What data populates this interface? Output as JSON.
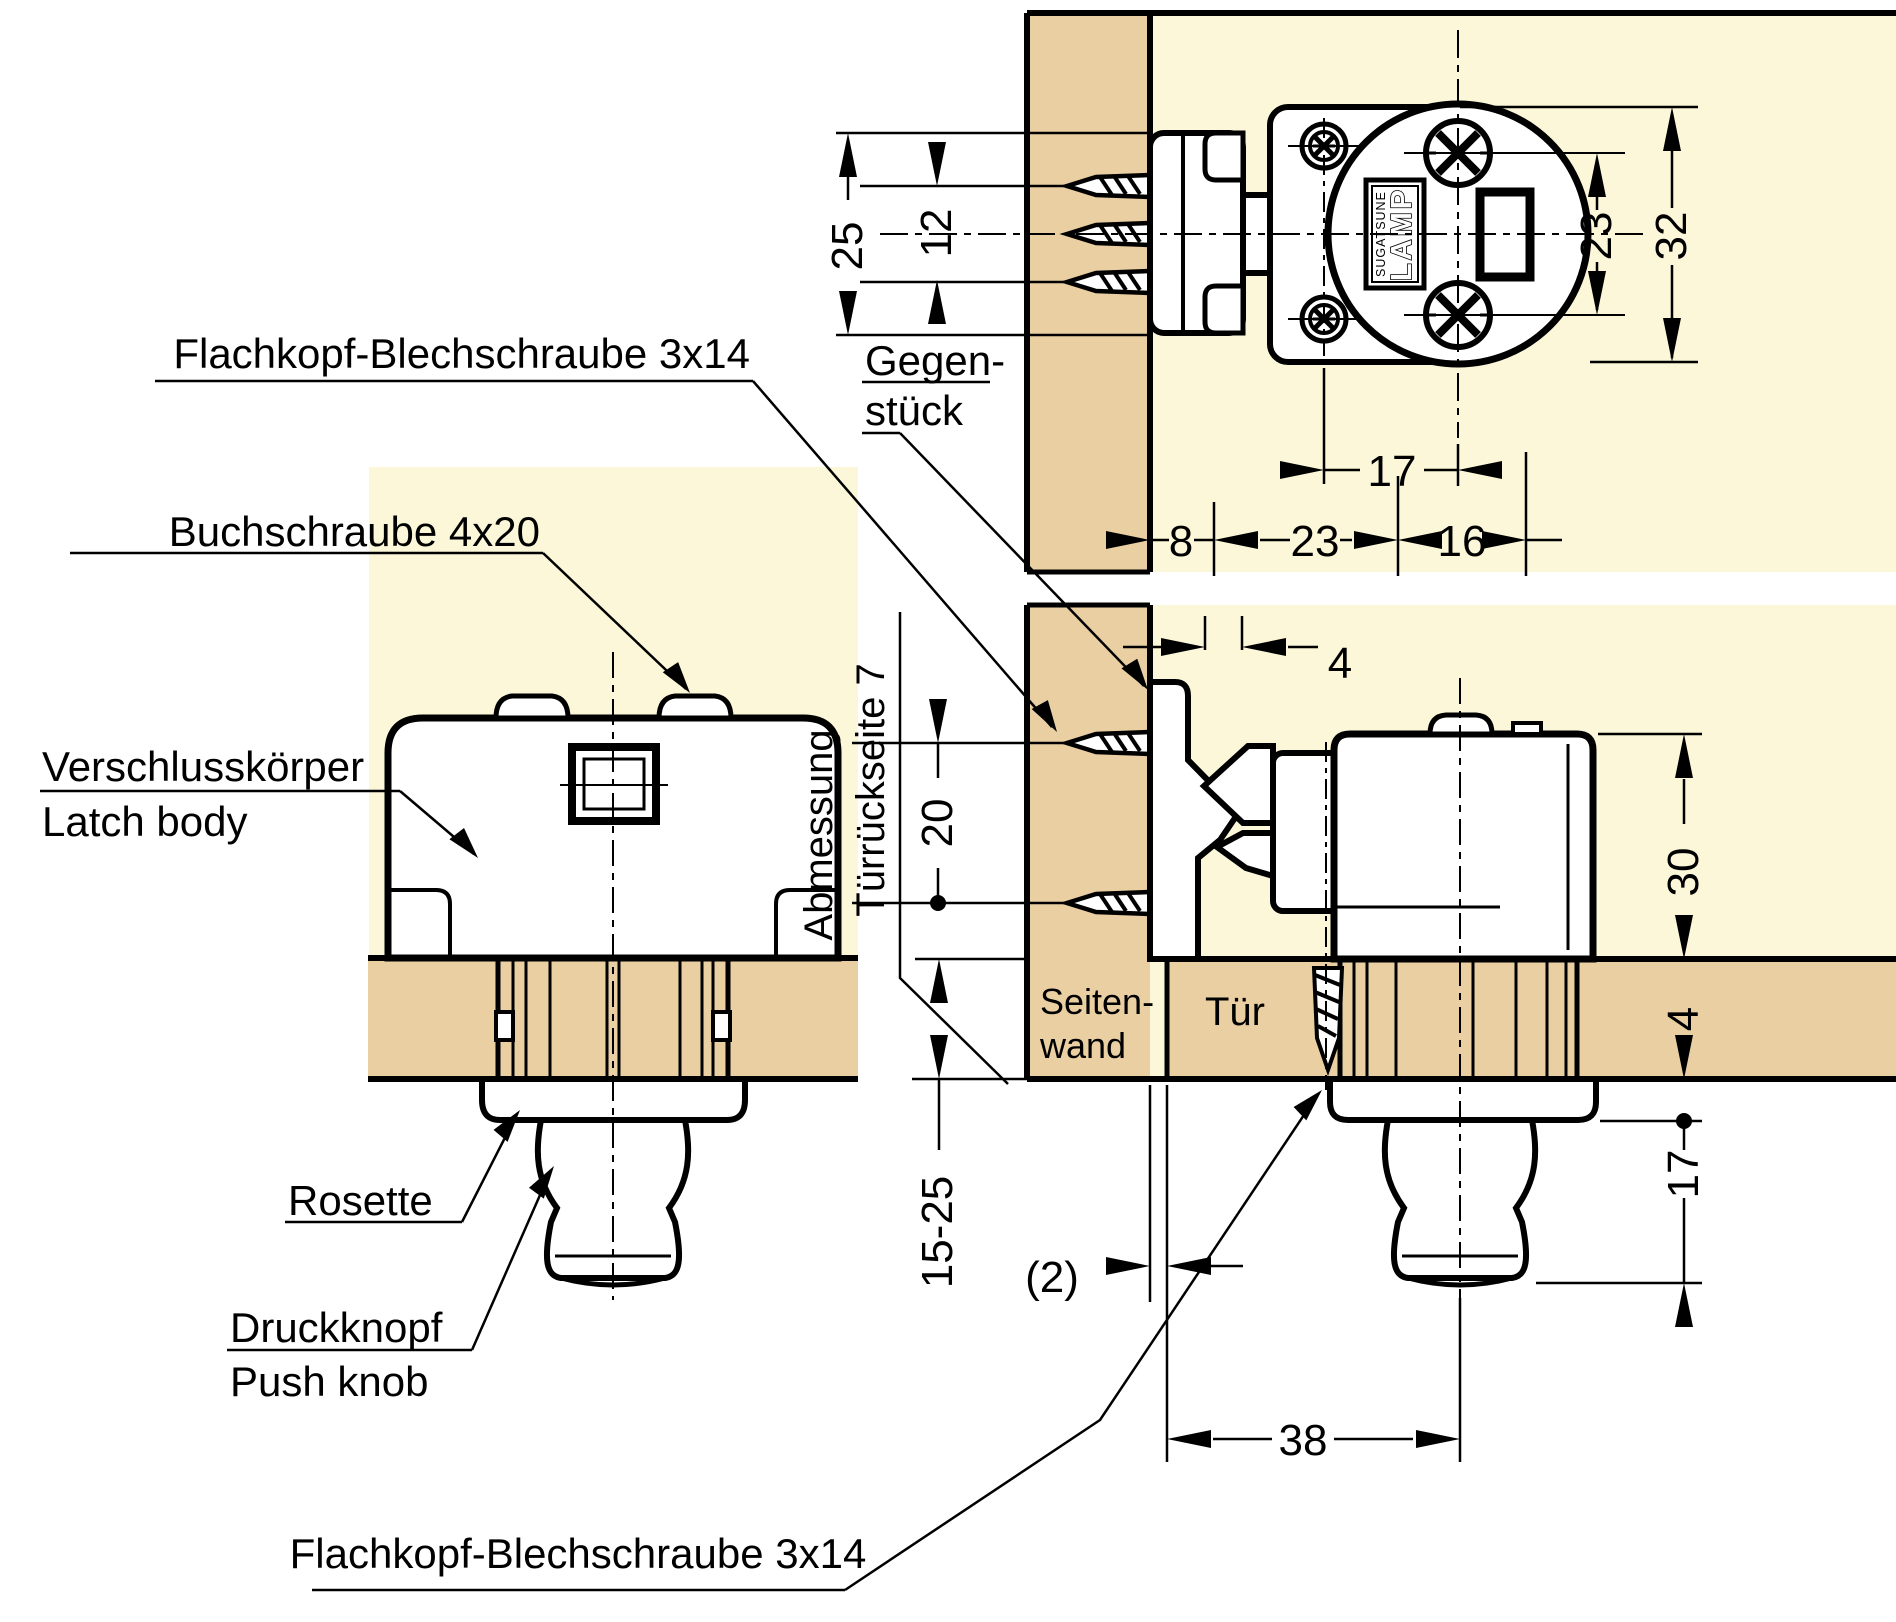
{
  "colors": {
    "background": "#ffffff",
    "cream": "#fbf7d8",
    "wood": "#eacfa3",
    "line": "#000000"
  },
  "labels": {
    "flachkopf_top": "Flachkopf-Blechschraube 3x14",
    "buchschraube": "Buchschraube 4x20",
    "verschlusskoerper": "Verschlusskörper",
    "latch_body": "Latch body",
    "rosette": "Rosette",
    "druckknopf": "Druckknopf",
    "push_knob": "Push knob",
    "gegen": "Gegen-",
    "stueck": "stück",
    "abmessung": "Abmessung",
    "tuerrueckseite": "Türrückseite 7",
    "seiten": "Seiten-",
    "wand": "wand",
    "tuer": "Tür",
    "flachkopf_bottom": "Flachkopf-Blechschraube 3x14",
    "logo": "LAMP",
    "logo_sub": "SUGATSUNE"
  },
  "dimensions": {
    "d25": "25",
    "d12": "12",
    "d23v": "23",
    "d32": "32",
    "d17": "17",
    "d8": "8",
    "d23h": "23",
    "d16": "16",
    "d4_keeper": "4",
    "d20": "20",
    "d30": "30",
    "d4_door": "4",
    "d15_25": "15-25",
    "d2": "(2)",
    "d38": "38",
    "d17_knob": "17"
  }
}
